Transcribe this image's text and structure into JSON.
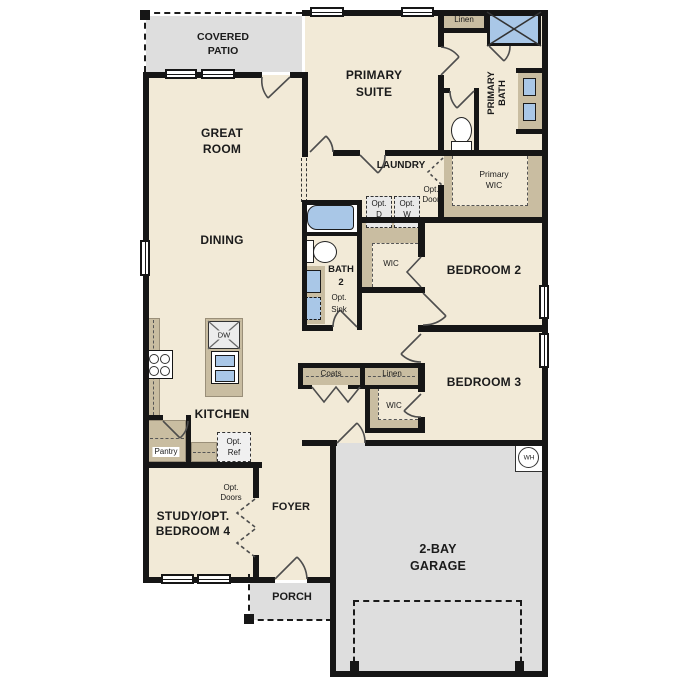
{
  "rooms": {
    "covered_patio": [
      "COVERED",
      "PATIO"
    ],
    "great_room": [
      "GREAT",
      "ROOM"
    ],
    "primary_suite": [
      "PRIMARY",
      "SUITE"
    ],
    "dining": [
      "DINING"
    ],
    "laundry": [
      "LAUNDRY"
    ],
    "primary_bath": [
      "PRIMARY",
      "BATH"
    ],
    "primary_wic": [
      "Primary",
      "WIC"
    ],
    "bath_2": [
      "BATH",
      "2"
    ],
    "bedroom_2": [
      "BEDROOM 2"
    ],
    "bedroom_3": [
      "BEDROOM 3"
    ],
    "kitchen": [
      "KITCHEN"
    ],
    "study": [
      "STUDY/OPT.",
      "BEDROOM 4"
    ],
    "foyer": [
      "FOYER"
    ],
    "porch": [
      "PORCH"
    ],
    "garage": [
      "2-BAY",
      "GARAGE"
    ]
  },
  "closets": {
    "linen_upper": "Linen",
    "linen_hall": "Linen",
    "coats": "Coats",
    "wic_bedroom2": "WIC",
    "wic_bedroom3": "WIC",
    "pantry": "Pantry"
  },
  "options": {
    "door": [
      "Opt.",
      "Door"
    ],
    "dryer": [
      "Opt.",
      "D"
    ],
    "washer": [
      "Opt.",
      "W"
    ],
    "sink": [
      "Opt.",
      "Sink"
    ],
    "ref": [
      "Opt.",
      "Ref"
    ],
    "doors": [
      "Opt.",
      "Doors"
    ]
  },
  "appliances": {
    "dishwasher": "DW",
    "water_heater": "WH"
  },
  "colors": {
    "floor": "#f2ead7",
    "exterior_surface": "#dedede",
    "casework": "#c9bda1",
    "fixture_blue": "#a9c7e7",
    "wall": "#161616"
  }
}
